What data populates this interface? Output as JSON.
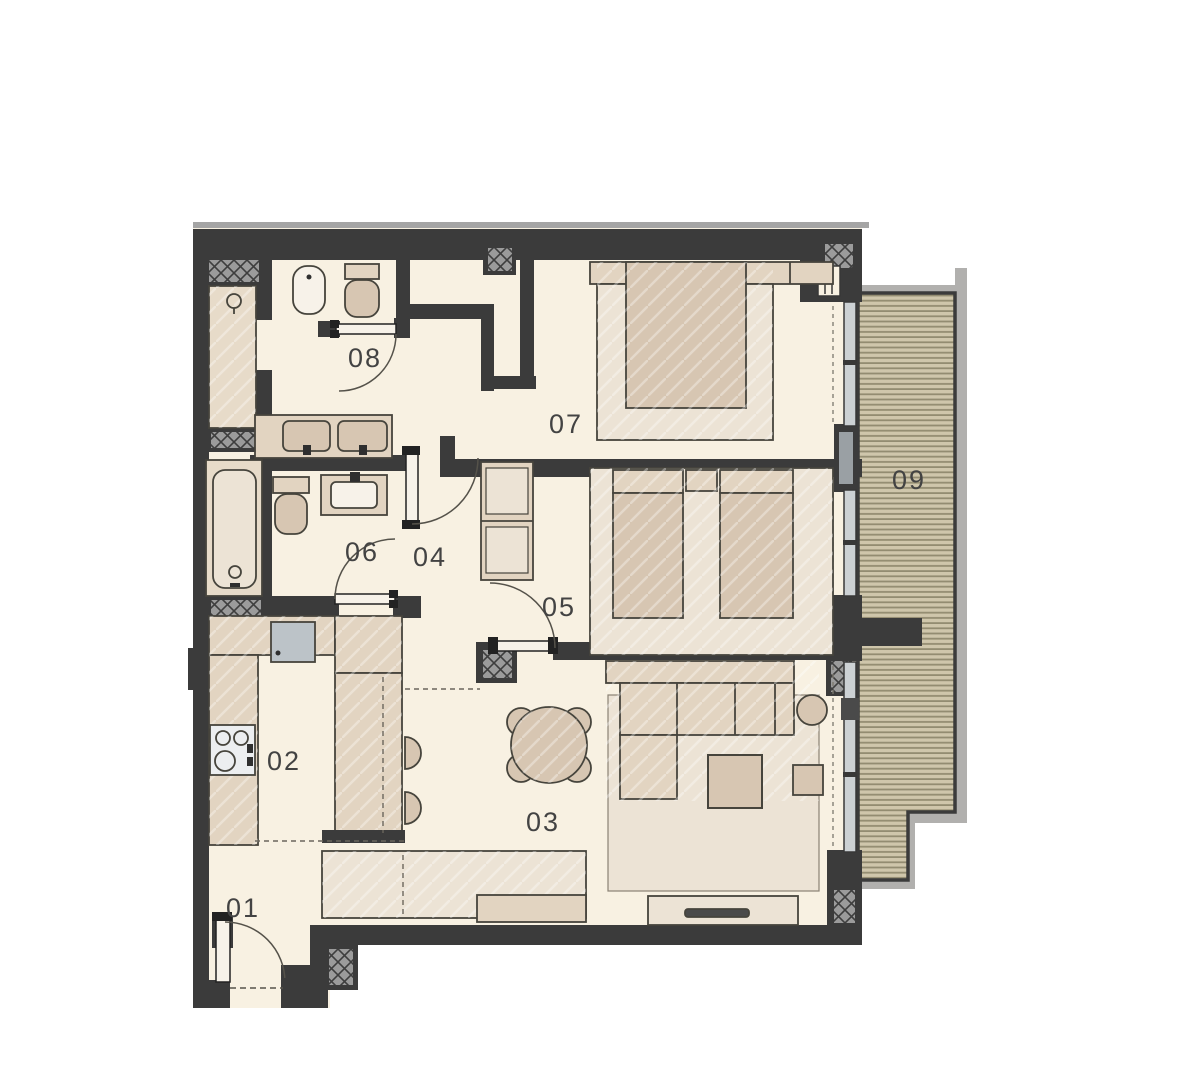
{
  "plan": {
    "rooms": [
      {
        "label": "01"
      },
      {
        "label": "02"
      },
      {
        "label": "03"
      },
      {
        "label": "04"
      },
      {
        "label": "05"
      },
      {
        "label": "06"
      },
      {
        "label": "07"
      },
      {
        "label": "08"
      },
      {
        "label": "09"
      }
    ]
  },
  "colors": {
    "bg": "#ffffff",
    "floor": "#f8f1e2",
    "wall": "#3b3b3b",
    "wall-outer": "#a5a5a5",
    "furn": "#e2d4c1",
    "furn-dark": "#d7c6b2",
    "furn-light": "#ece3d5",
    "outline": "#46443c",
    "deck": "#cfc6ab",
    "deck-line": "#938c71",
    "rail": "#b1b0ae",
    "appliance": "#bcc3c8",
    "glass": "#ccd1d4",
    "fixture": "#f7f2e9",
    "label": "#434343",
    "hatch": "#9b9b9b"
  }
}
